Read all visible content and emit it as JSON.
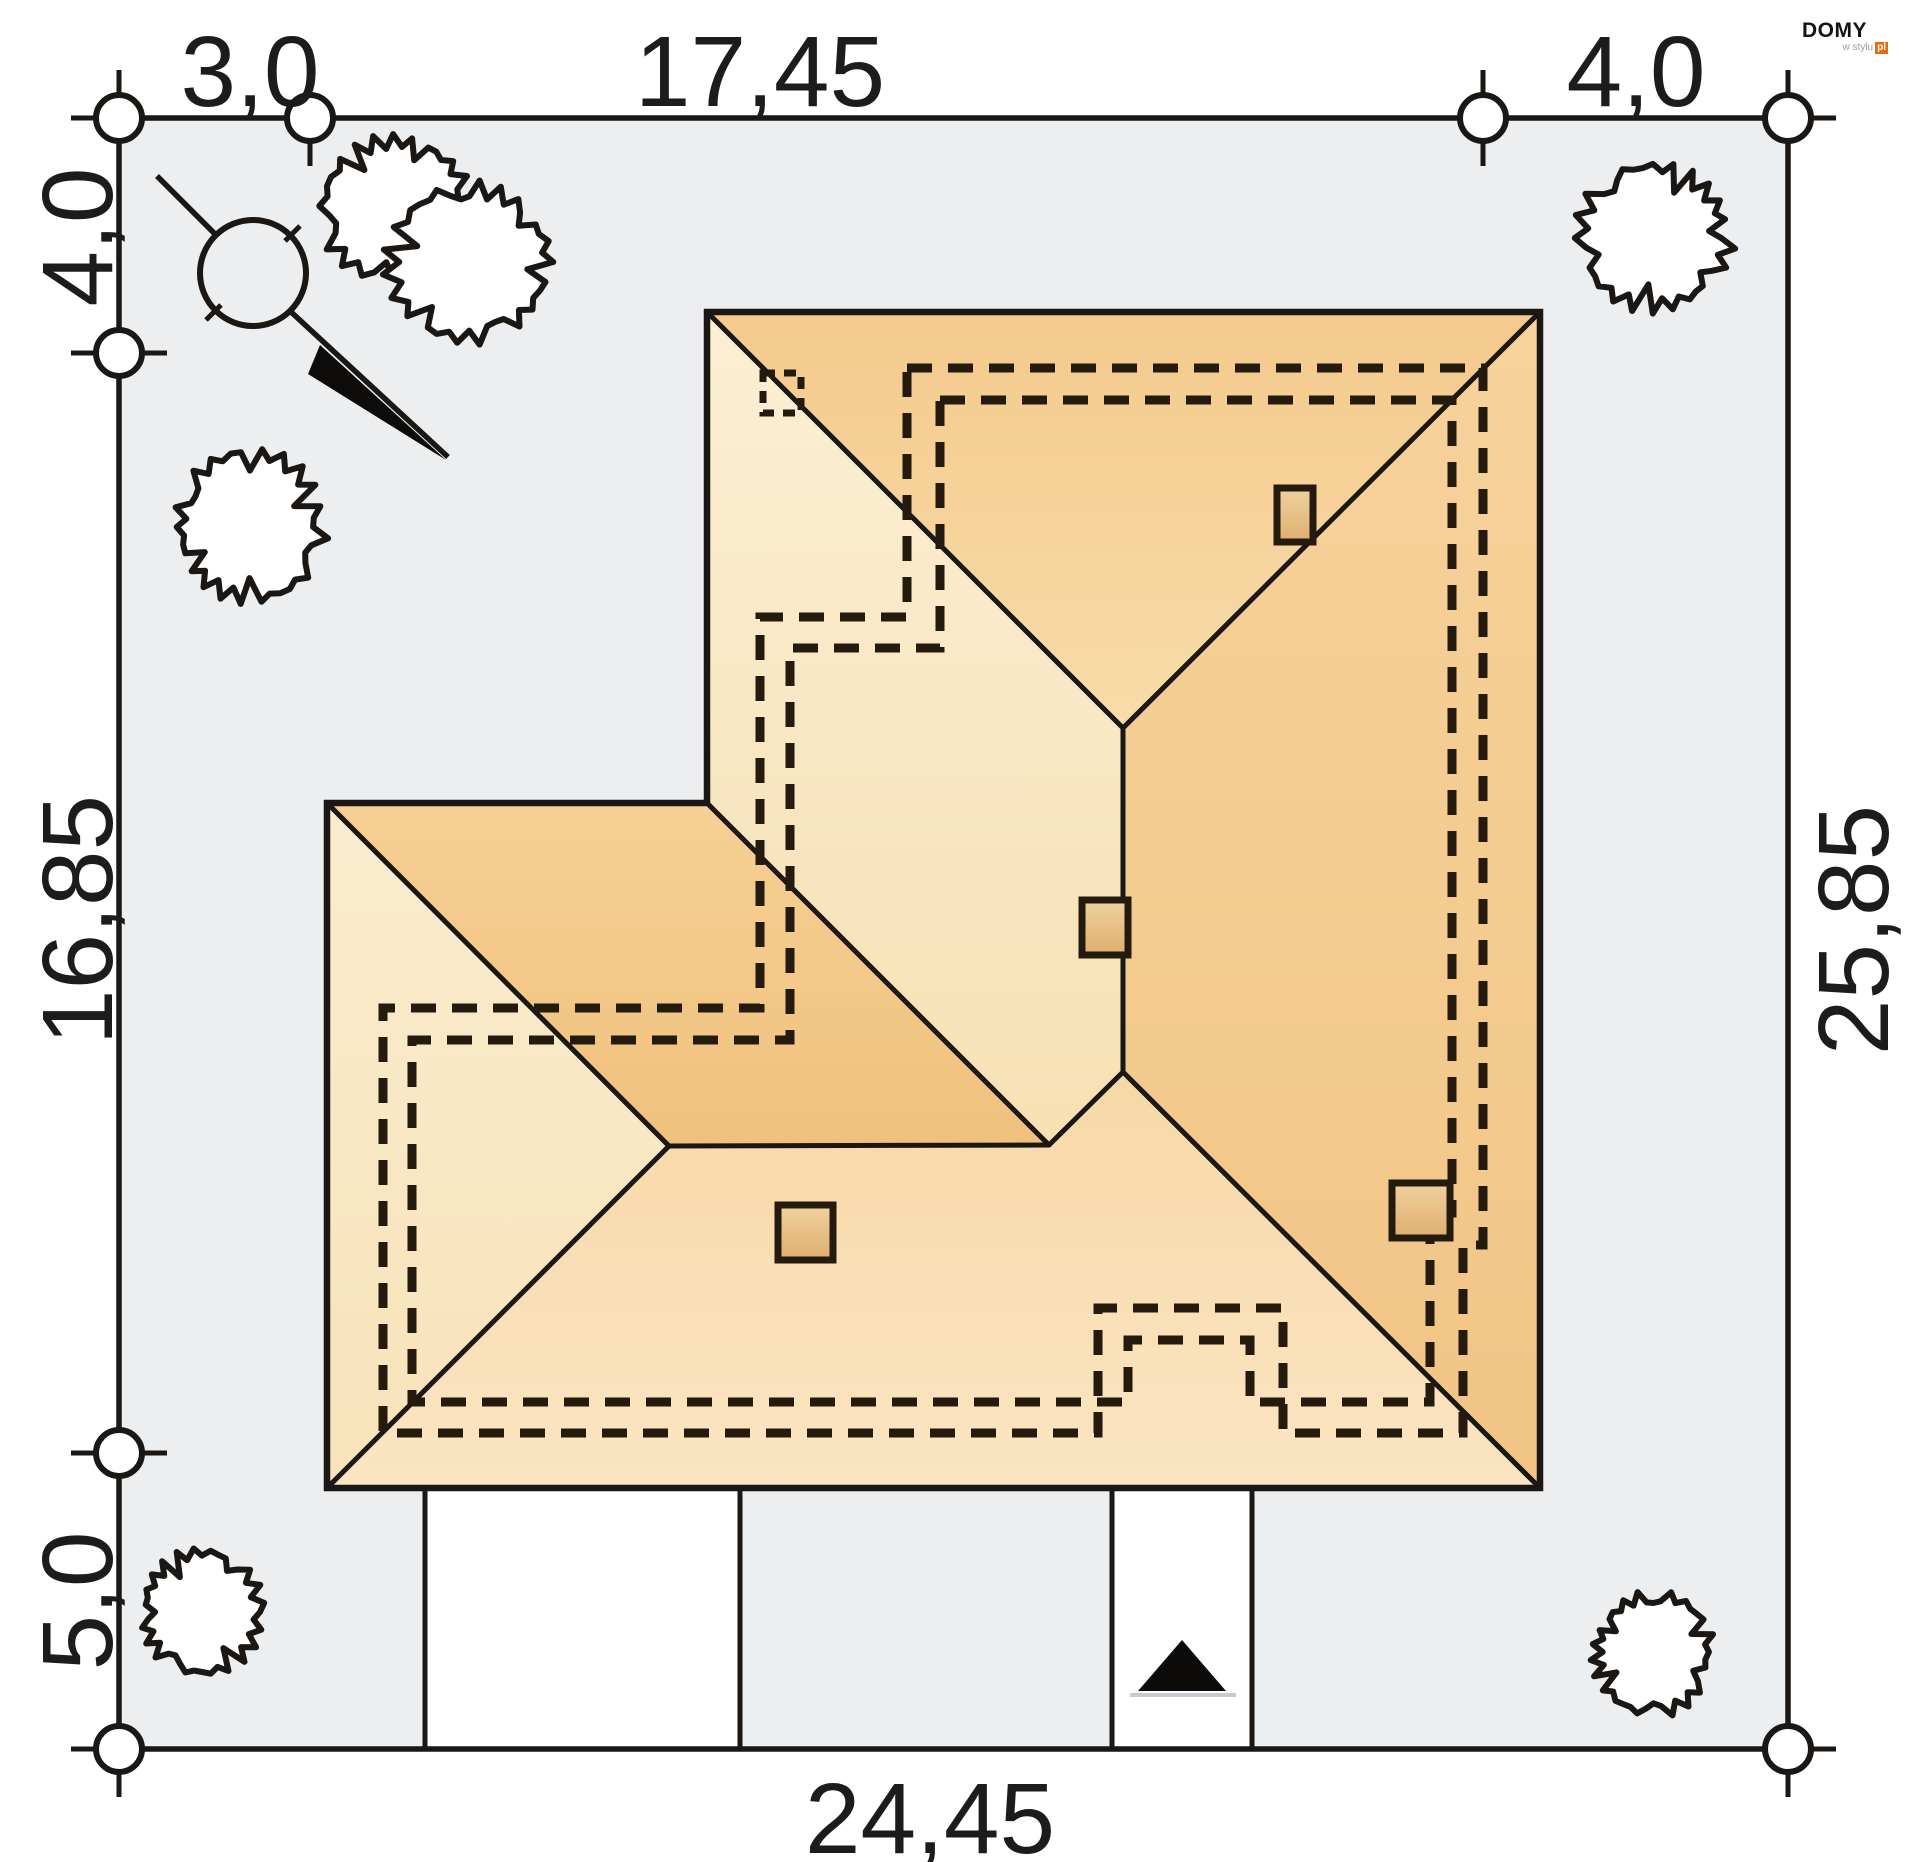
{
  "logo": {
    "brand": "DOMY",
    "tagline": "w stylu",
    "suffix": "pl"
  },
  "dimensions": {
    "top_left": "3,0",
    "top_middle": "17,45",
    "top_right": "4,0",
    "left_top": "4,0",
    "left_middle": "16,85",
    "left_bottom": "5,0",
    "right_side": "25,85",
    "bottom": "24,45"
  },
  "colors": {
    "page-bg": "#FFFFFF",
    "plot-fill": "#ECEEF0",
    "line": "#1A1714",
    "dash": "#241A0E",
    "roof-north-top": "#F4CA8D",
    "roof-north-bottom": "#F8DCA9",
    "roof-east-top": "#F7D29C",
    "roof-east-bottom": "#F1C585",
    "roof-west-top": "#FBEFD5",
    "roof-west-bottom": "#F7E0B3",
    "roof-south-top": "#F7D8A7",
    "roof-south-bottom": "#FAE5C2",
    "roof-left-top": "#F6D094",
    "roof-left-bottom": "#F0C17D",
    "roof-lwest-top": "#FAECCF",
    "roof-lwest-bottom": "#F8E3B9",
    "chimney-top": "#F0D2A0",
    "chimney-bottom": "#DFAE6D",
    "text": "#1C1C1C",
    "logo-orange": "#E8690E",
    "logo-gray": "#9B9B9B",
    "gate": "#C7CBD0"
  },
  "icons": {
    "trees": [
      {
        "name": "tree-icon",
        "cx": 398,
        "cy": 206,
        "r": 78,
        "seed": 3
      },
      {
        "name": "tree-icon",
        "cx": 474,
        "cy": 262,
        "r": 86,
        "seed": 7
      },
      {
        "name": "tree-icon",
        "cx": 1658,
        "cy": 238,
        "r": 80,
        "seed": 11
      },
      {
        "name": "tree-icon",
        "cx": 246,
        "cy": 527,
        "r": 78,
        "seed": 5
      },
      {
        "name": "tree-icon",
        "cx": 198,
        "cy": 1612,
        "r": 64,
        "seed": 9
      },
      {
        "name": "tree-icon",
        "cx": 1650,
        "cy": 1652,
        "r": 63,
        "seed": 13
      }
    ],
    "chimneys": [
      {
        "name": "chimney",
        "x": 1277,
        "y": 488,
        "w": 36,
        "h": 54
      },
      {
        "name": "chimney",
        "x": 1082,
        "y": 900,
        "w": 46,
        "h": 55
      },
      {
        "name": "chimney",
        "x": 778,
        "y": 1205,
        "w": 55,
        "h": 55
      },
      {
        "name": "chimney",
        "x": 1392,
        "y": 1183,
        "w": 58,
        "h": 55
      }
    ],
    "survey_points": [
      {
        "x": 119,
        "y": 118,
        "ticks": "both"
      },
      {
        "x": 310,
        "y": 118,
        "ticks": "v"
      },
      {
        "x": 1483,
        "y": 118,
        "ticks": "v"
      },
      {
        "x": 1788,
        "y": 118,
        "ticks": "both"
      },
      {
        "x": 119,
        "y": 353,
        "ticks": "h"
      },
      {
        "x": 119,
        "y": 1453,
        "ticks": "h"
      },
      {
        "x": 119,
        "y": 1749,
        "ticks": "both"
      },
      {
        "x": 1788,
        "y": 1749,
        "ticks": "both"
      }
    ]
  }
}
